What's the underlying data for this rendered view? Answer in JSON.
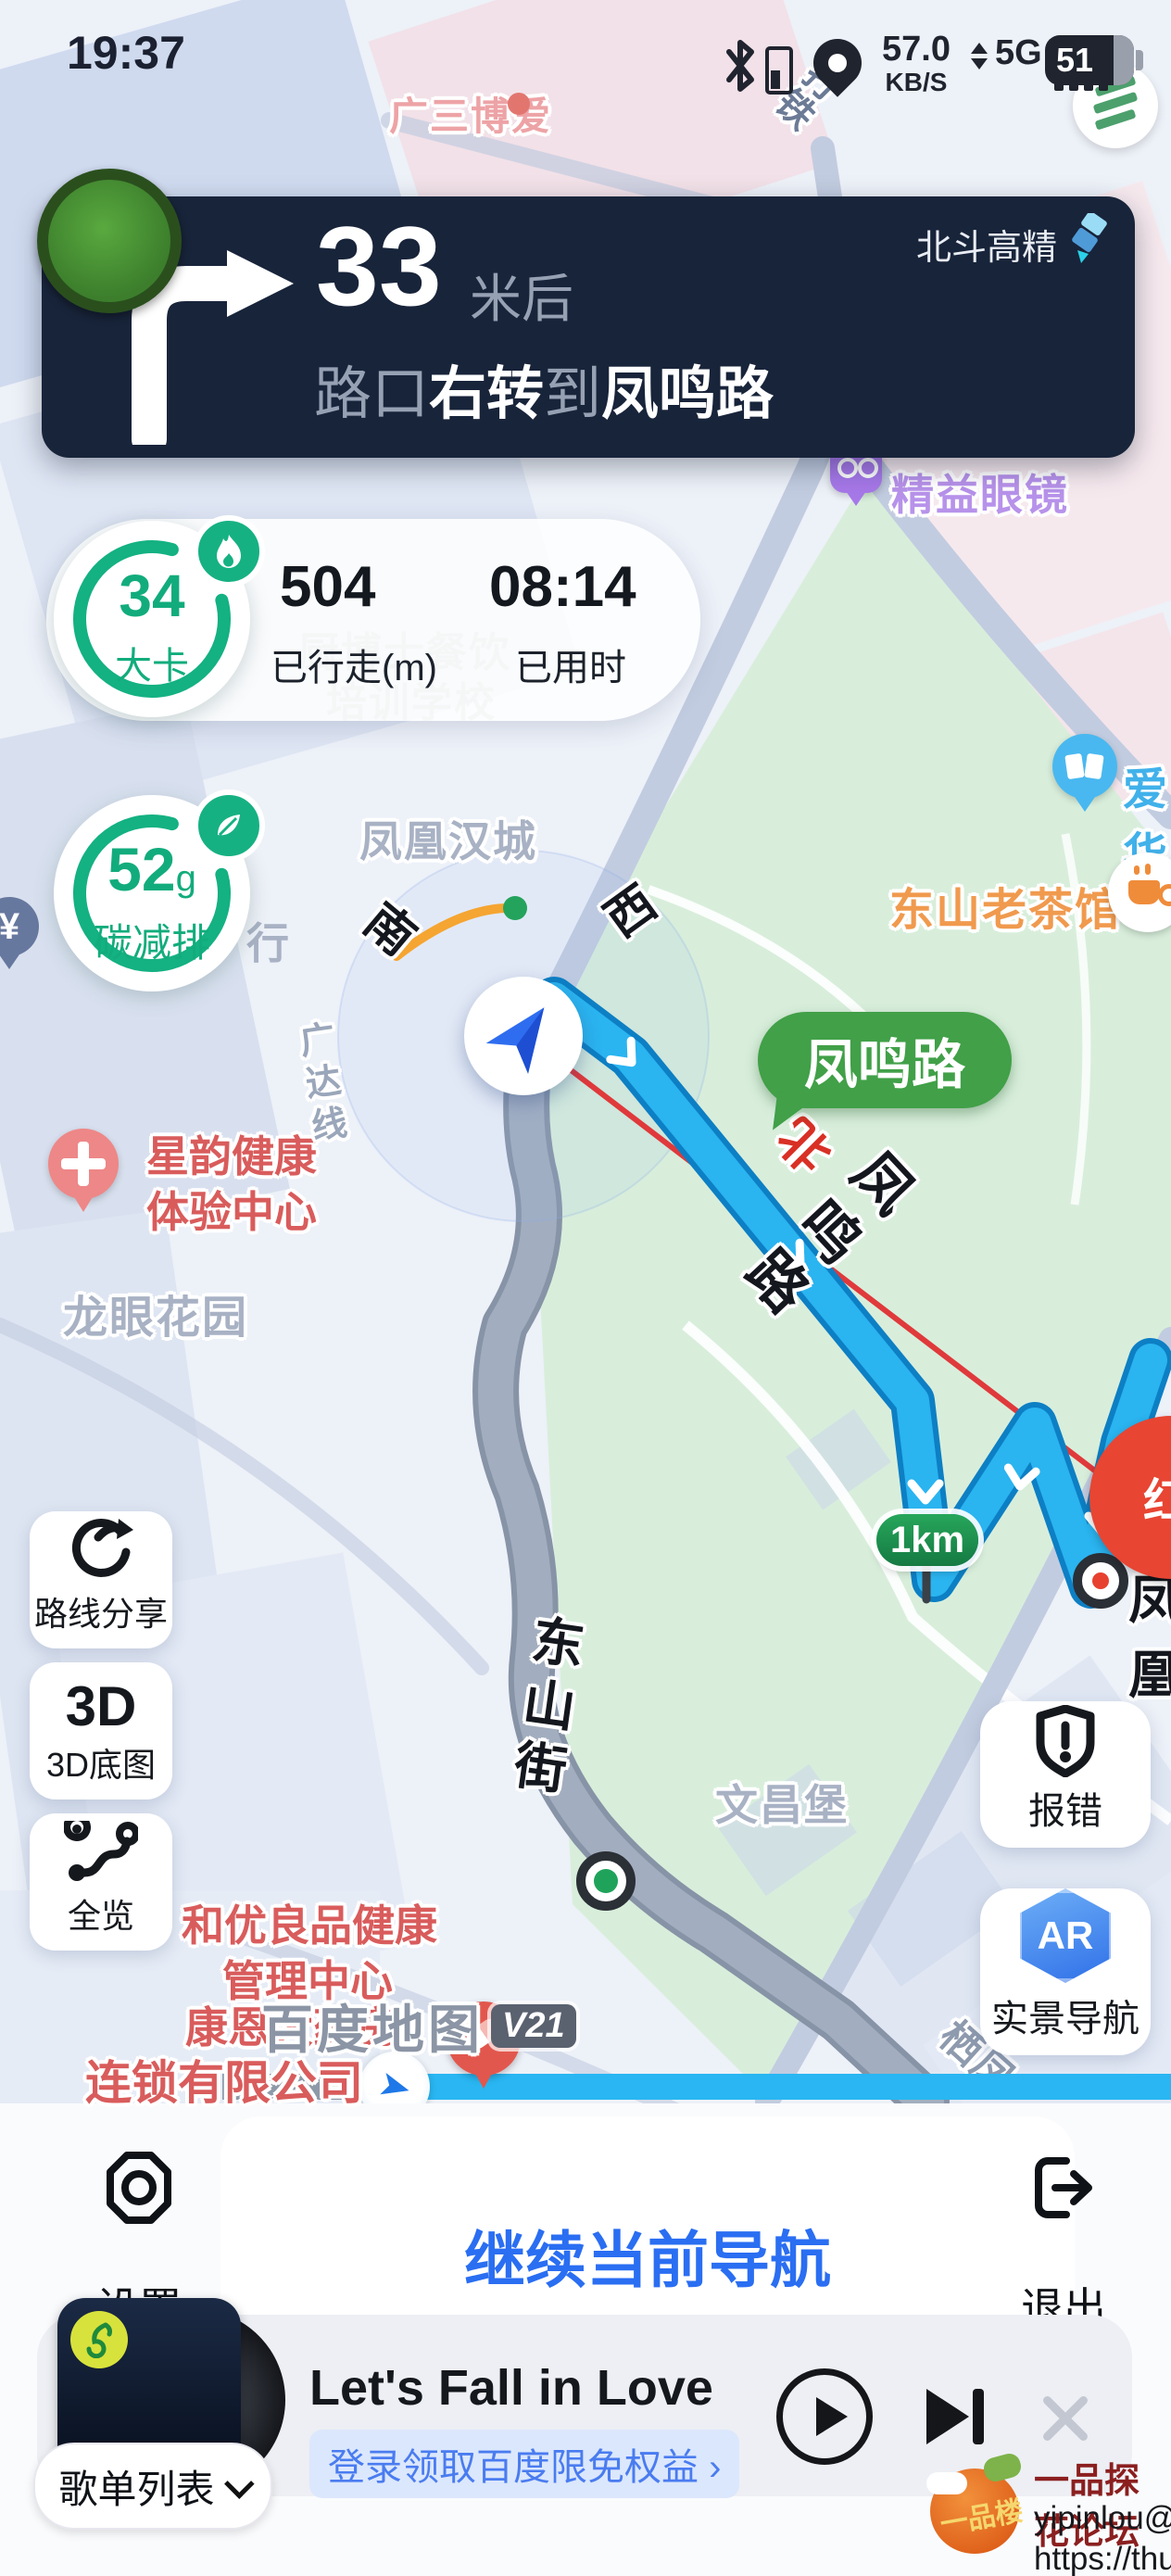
{
  "status_bar": {
    "time": "19:37",
    "net_speed": "57.0",
    "net_unit": "KB/S",
    "net_type": "5G",
    "battery_percent": "51"
  },
  "nav_banner": {
    "badge": "北斗高精",
    "distance": "33",
    "distance_unit": "米后",
    "prefix": "路口",
    "action": "右转",
    "connector": "到",
    "road": "凤鸣路"
  },
  "trip_stats": {
    "calories": "34",
    "calories_unit": "大卡",
    "distance_value": "504",
    "distance_label": "已行走(m)",
    "duration_value": "08:14",
    "duration_label": "已用时",
    "carbon_value": "52",
    "carbon_unit": "g",
    "carbon_label": "碳减排"
  },
  "map": {
    "route_bubble": "凤鸣路",
    "km_marker": "1km",
    "logo": "百度地图",
    "logo_version": "V21",
    "labels": {
      "top_pink": "广三博爱",
      "top_street": "打铁",
      "phoenix_town": "凤凰汉城",
      "dir_south": "南",
      "dir_west": "西",
      "dir_north": "北",
      "glasses": "精益眼镜",
      "aihua": "爱华",
      "teahouse": "东山老茶馆",
      "yuan": "¥",
      "health_center_1": "星韵健康",
      "health_center_2": "体验中心",
      "guangda_line": "广达线",
      "longyan": "龙眼花园",
      "school_1": "厨博士餐饮",
      "school_2": "培训学校",
      "bank_partial": "行",
      "fengming_road": "凤鸣路",
      "dongshan_street": "东山街",
      "wenchang": "文昌堡",
      "heyou_1": "和优良品健康",
      "heyou_2": "管理中心",
      "pharmacy": "康恩大药房",
      "pharmacy_2": "连锁有限公司",
      "qifeng": "栖凤",
      "phoenix_dest": "凤凰",
      "red_poi": "红"
    }
  },
  "side_buttons": {
    "share": "路线分享",
    "three_d": "3D",
    "three_d_label": "3D底图",
    "overview": "全览",
    "report": "报错",
    "ar": "AR",
    "ar_label": "实景导航"
  },
  "bottom_bar": {
    "settings": "设置",
    "continue": "继续当前导航",
    "exit": "退出"
  },
  "music_player": {
    "title": "Let's Fall in Love",
    "promo": "登录领取百度限免权益 ›",
    "playlist": "歌单列表"
  },
  "watermark": {
    "logo_text": "一品楼",
    "line1": "一品探花论坛",
    "line2": "yipinlou@pm.me",
    "line3": "https://thua9.info"
  }
}
